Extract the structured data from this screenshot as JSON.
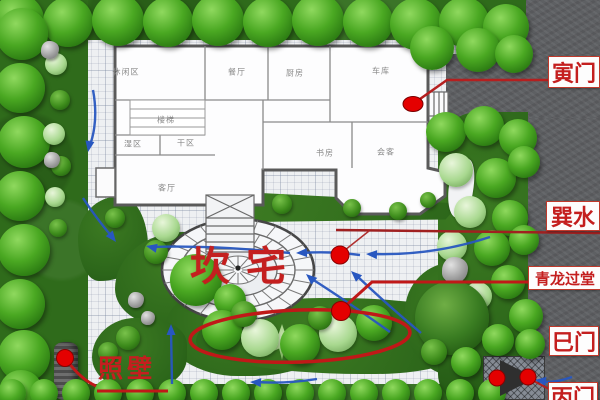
{
  "legend": {
    "yin_gate": "寅门",
    "xun_water": "巽水",
    "qinglong_pass": "青龙过堂",
    "si_gate": "巳门",
    "bing_gate": "丙门",
    "screen_wall": "照壁",
    "kan_house": "坎宅"
  },
  "rooms": [
    {
      "label": "休闲区",
      "x": 126,
      "y": 72
    },
    {
      "label": "餐厅",
      "x": 237,
      "y": 72
    },
    {
      "label": "厨房",
      "x": 295,
      "y": 73
    },
    {
      "label": "车库",
      "x": 381,
      "y": 71
    },
    {
      "label": "楼梯",
      "x": 166,
      "y": 120
    },
    {
      "label": "湿区",
      "x": 133,
      "y": 144
    },
    {
      "label": "干区",
      "x": 186,
      "y": 143
    },
    {
      "label": "书房",
      "x": 325,
      "y": 153
    },
    {
      "label": "会客",
      "x": 386,
      "y": 152
    },
    {
      "label": "客厅",
      "x": 167,
      "y": 188
    }
  ],
  "colors": {
    "annotation_red": "#c01818",
    "dot_red": "#e40000",
    "arrow_blue": "#2857c0",
    "lawn_green": "#2f6b1b",
    "tree_green": "#4aa822",
    "road_gray": "#5e6063",
    "paving": "#eef0f2"
  },
  "vegetation": {
    "trees": [
      [
        18,
        20,
        26,
        "t"
      ],
      [
        68,
        22,
        25,
        "t"
      ],
      [
        118,
        20,
        26,
        "t"
      ],
      [
        168,
        22,
        25,
        "t"
      ],
      [
        218,
        20,
        26,
        "t"
      ],
      [
        268,
        22,
        25,
        "t"
      ],
      [
        318,
        20,
        26,
        "t"
      ],
      [
        368,
        22,
        25,
        "t"
      ],
      [
        416,
        24,
        26,
        "t"
      ],
      [
        464,
        22,
        25,
        "t"
      ],
      [
        506,
        27,
        23,
        "t"
      ],
      [
        432,
        48,
        22,
        "t"
      ],
      [
        478,
        50,
        22,
        "t"
      ],
      [
        514,
        54,
        19,
        "t"
      ],
      [
        22,
        34,
        26,
        "t"
      ],
      [
        20,
        88,
        25,
        "t"
      ],
      [
        24,
        142,
        26,
        "t"
      ],
      [
        20,
        196,
        25,
        "t"
      ],
      [
        24,
        250,
        26,
        "t"
      ],
      [
        20,
        304,
        25,
        "t"
      ],
      [
        24,
        356,
        26,
        "t"
      ],
      [
        21,
        392,
        22,
        "t"
      ],
      [
        56,
        64,
        11,
        "l"
      ],
      [
        60,
        100,
        10,
        "b"
      ],
      [
        54,
        134,
        11,
        "l"
      ],
      [
        61,
        166,
        10,
        "b"
      ],
      [
        55,
        197,
        10,
        "l"
      ],
      [
        50,
        50,
        9,
        "r"
      ],
      [
        52,
        160,
        8,
        "r"
      ],
      [
        58,
        228,
        9,
        "b"
      ],
      [
        115,
        218,
        10,
        "b"
      ],
      [
        166,
        228,
        14,
        "l"
      ],
      [
        156,
        252,
        12,
        "b"
      ],
      [
        196,
        280,
        26,
        "t"
      ],
      [
        230,
        300,
        16,
        "t"
      ],
      [
        282,
        342,
        18,
        "p"
      ],
      [
        136,
        300,
        8,
        "r"
      ],
      [
        148,
        318,
        7,
        "r"
      ],
      [
        128,
        338,
        12,
        "b"
      ],
      [
        108,
        352,
        10,
        "b"
      ],
      [
        282,
        204,
        10,
        "b"
      ],
      [
        352,
        208,
        9,
        "b"
      ],
      [
        398,
        211,
        9,
        "b"
      ],
      [
        428,
        200,
        8,
        "b"
      ],
      [
        446,
        132,
        20,
        "t"
      ],
      [
        484,
        126,
        20,
        "t"
      ],
      [
        518,
        138,
        19,
        "t"
      ],
      [
        456,
        170,
        17,
        "l"
      ],
      [
        496,
        178,
        20,
        "t"
      ],
      [
        524,
        162,
        16,
        "t"
      ],
      [
        470,
        212,
        16,
        "l"
      ],
      [
        510,
        218,
        18,
        "t"
      ],
      [
        452,
        246,
        15,
        "l"
      ],
      [
        492,
        248,
        18,
        "t"
      ],
      [
        524,
        240,
        15,
        "t"
      ],
      [
        508,
        282,
        17,
        "t"
      ],
      [
        478,
        296,
        14,
        "l"
      ],
      [
        526,
        316,
        17,
        "t"
      ],
      [
        530,
        344,
        15,
        "t"
      ],
      [
        455,
        270,
        13,
        "r"
      ],
      [
        452,
        318,
        37,
        "T"
      ],
      [
        222,
        330,
        20,
        "t"
      ],
      [
        260,
        338,
        19,
        "l"
      ],
      [
        300,
        344,
        20,
        "t"
      ],
      [
        338,
        333,
        19,
        "l"
      ],
      [
        374,
        323,
        18,
        "t"
      ],
      [
        244,
        314,
        13,
        "b"
      ],
      [
        320,
        318,
        12,
        "b"
      ],
      [
        498,
        340,
        16,
        "t"
      ],
      [
        466,
        362,
        15,
        "t"
      ],
      [
        434,
        352,
        13,
        "b"
      ]
    ]
  }
}
